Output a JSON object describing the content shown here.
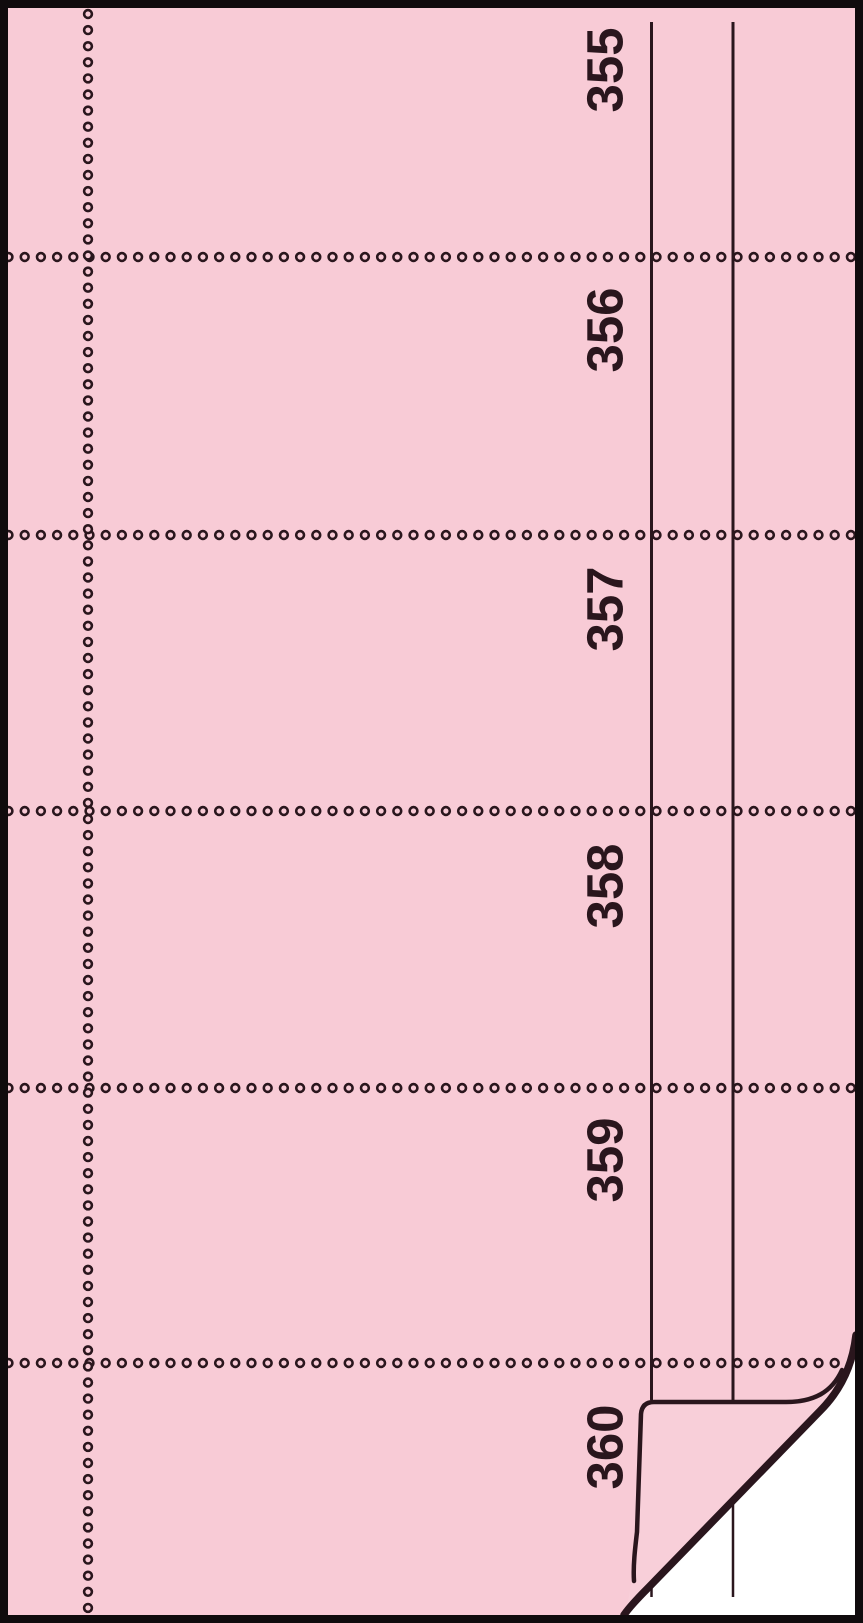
{
  "sheet": {
    "sections": [
      {
        "number": "355"
      },
      {
        "number": "356"
      },
      {
        "number": "357"
      },
      {
        "number": "358"
      },
      {
        "number": "359"
      },
      {
        "number": "360"
      }
    ],
    "colors": {
      "paper_pink": "#f8cbd6",
      "flap_pink": "#f8cfd9",
      "ink": "#2a161d",
      "border": "#100b0d",
      "under_sheet_white": "#ffffff"
    }
  }
}
